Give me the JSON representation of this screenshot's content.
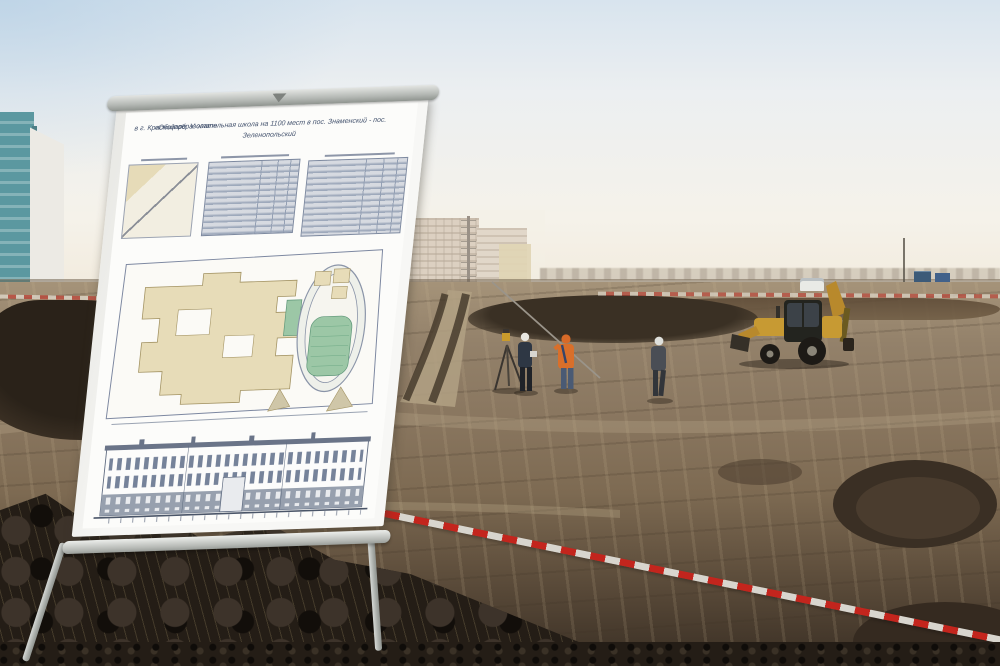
{
  "poster": {
    "title_line1": "«Общеобразовательная школа на 1100 мест в пос. Знаменский - пос. Зеленопольский",
    "title_line2": "в г. Краснодаре. V этап»"
  },
  "colors": {
    "sky_top": "#d8e4ee",
    "sky_horizon": "#f1e9da",
    "teal_building": "#5b98a0",
    "tape_red": "#c3251d",
    "tape_white": "#d8d5ce",
    "excavator_yellow": "#c79a33",
    "safety_orange": "#d96f2a",
    "plan_building_beige": "#e7dcb8",
    "plan_field_green": "#9cc7a6",
    "soil_mid": "#8c7b62",
    "soil_dark": "#241d16"
  }
}
